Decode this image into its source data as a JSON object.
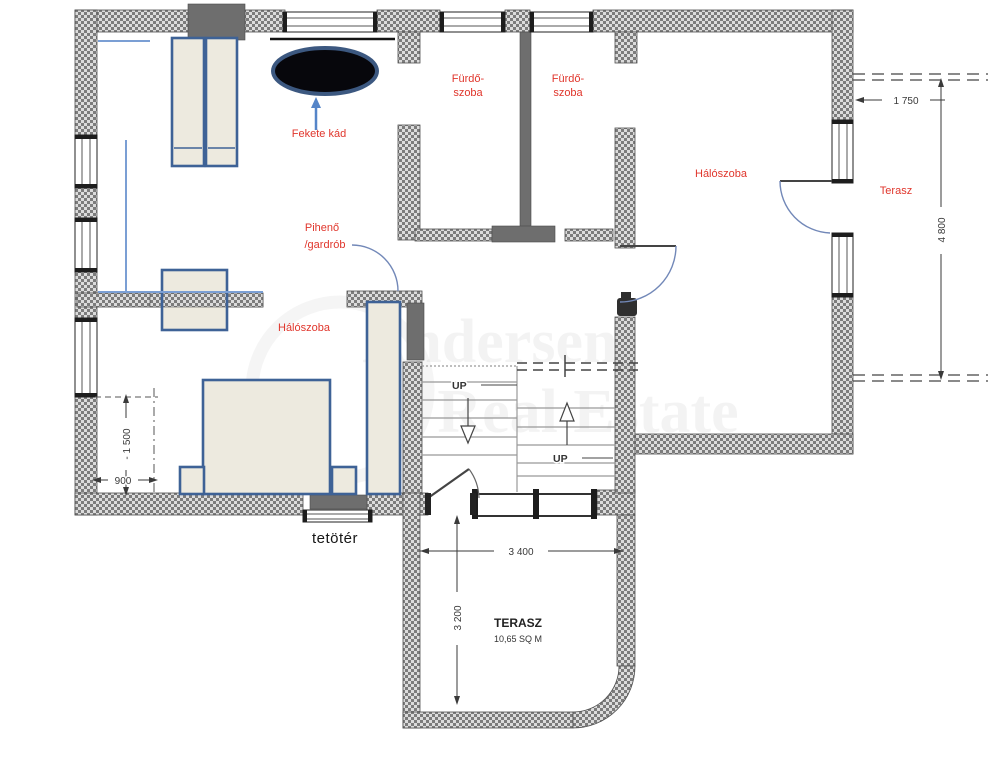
{
  "title": "tetőtér floor plan",
  "rooms": {
    "bathroom1": {
      "line1": "Fürdő-",
      "line2": "szoba"
    },
    "bathroom2": {
      "line1": "Fürdő-",
      "line2": "szoba"
    },
    "bedroom_main": {
      "label": "Hálószoba"
    },
    "terrace_upper": {
      "label": "Terasz"
    },
    "lounge": {
      "line1": "Pihenő",
      "line2": "/gardrób"
    },
    "bedroom_left": {
      "label": "Hálószoba"
    },
    "terrace_lower": {
      "title": "TERASZ",
      "area": "10,65 SQ M"
    }
  },
  "annotations": {
    "black_tub": "Fekete kád",
    "attic": "tetötér",
    "up_left": "UP",
    "up_right": "UP"
  },
  "dimensions": {
    "terrace_width": "1 750",
    "terrace_length": "4 800",
    "knee_height": "- 1 500",
    "knee_width": "900",
    "lower_terrace_width": "3 400",
    "lower_terrace_depth": "3 200"
  },
  "watermark": {
    "line1": "Andersen",
    "line2": "Real Estate"
  },
  "colors": {
    "wall_dark": "#6e6e6e",
    "furniture_fill": "#edeadf",
    "furniture_border": "#3e6296",
    "label_red": "#e0362c",
    "dim_text": "#3a3a3a",
    "tub_fill": "#07070c",
    "blue_line": "#7b9fd4"
  }
}
